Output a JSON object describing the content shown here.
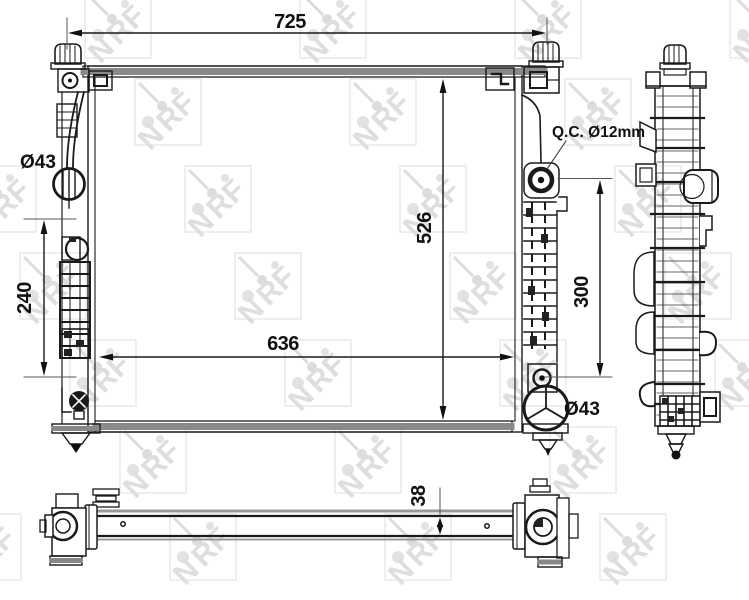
{
  "watermark": {
    "n": "N",
    "r": "R",
    "f": "F"
  },
  "labels": {
    "overall_width": "725",
    "overall_height": "526",
    "core_width": "636",
    "left_span": "240",
    "right_span": "300",
    "thickness": "38",
    "inlet_diameter": "Ø43",
    "outlet_diameter": "Ø43",
    "quick_connector": "Q.C. Ø12mm"
  }
}
